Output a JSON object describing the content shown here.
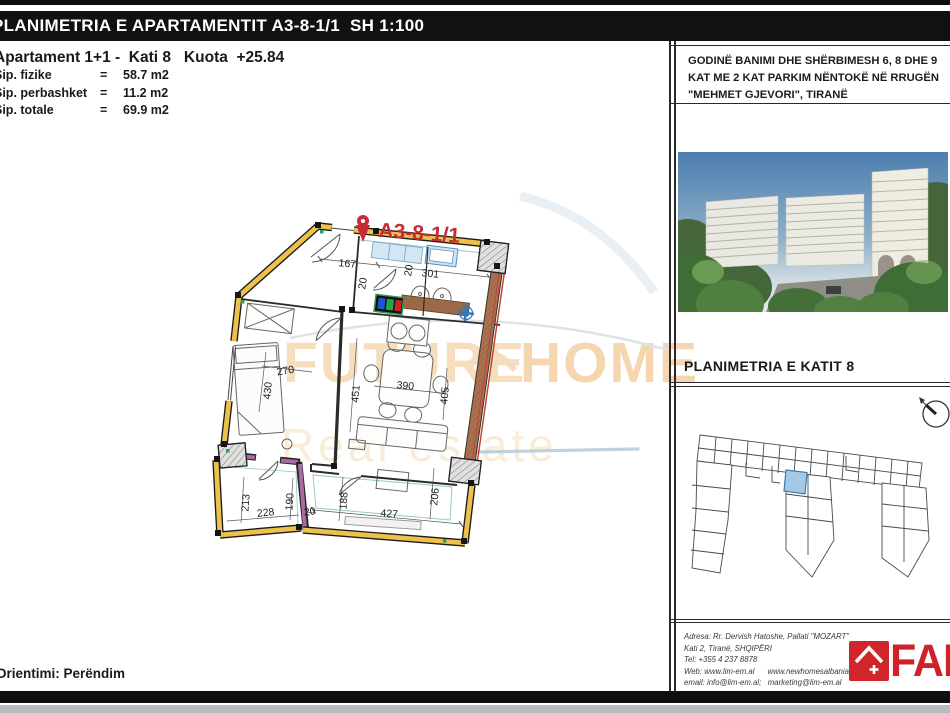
{
  "page": {
    "title_bar": "PLANIMETRIA E APARTAMENTIT A3-8-1/1  SH 1:100",
    "subtitle": "Apartament 1+1 -  Kati 8   Kuota  +25.84",
    "orientation": "Orientimi: Perëndim"
  },
  "areas": [
    {
      "label": "Sip. fizike",
      "eq": "=",
      "value": "58.7 m2"
    },
    {
      "label": "Sip. perbashket",
      "eq": "=",
      "value": "11.2 m2"
    },
    {
      "label": "Sip. totale",
      "eq": "=",
      "value": "69.9 m2"
    }
  ],
  "plan": {
    "unit_label": "A3-8-1/1",
    "dims": [
      "167",
      "20",
      "301",
      "270",
      "430",
      "451",
      "390",
      "405",
      "213",
      "228",
      "190",
      "20",
      "188",
      "427",
      "206"
    ]
  },
  "watermark": {
    "word1": "FUTURE",
    "word2": "HOME",
    "tagline": "Real estate"
  },
  "side_panel": {
    "project_title": "GODINË BANIMI DHE SHËRBIMESH 6, 8 DHE 9 KAT ME 2 KAT PARKIM NËNTOKË NË RRUGËN \"MEHMET GJEVORI\", TIRANË",
    "key_plan_title": "PLANIMETRIA E KATIT 8",
    "footer": {
      "address_line1": "Adresa: Rr. Dervish Hatoshe, Pallati \"MOZART\"",
      "address_line2": "Kati 2, Tiranë, SHQIPËRI",
      "address_line3": "Tel: +355 4 237 8878",
      "address_line4": "Web: www.lim-em.al      www.newhomesalbania.al",
      "address_line5": "email: info@lim-em.al;   marketing@lim-em.al",
      "logo_text": "FARE"
    }
  },
  "colors": {
    "wall_highlight": "#edc14a",
    "wall_purple": "#a96ba0",
    "balcony_brown": "#a9714f",
    "accent_red": "#c92a35",
    "rail_teal": "#3f9e8a",
    "fixture_blue": "#4d86b0",
    "keyplan_highlight": "#a3c9e6",
    "logo_red": "#cf2127",
    "watermark_peach": "#f6ddbd"
  }
}
